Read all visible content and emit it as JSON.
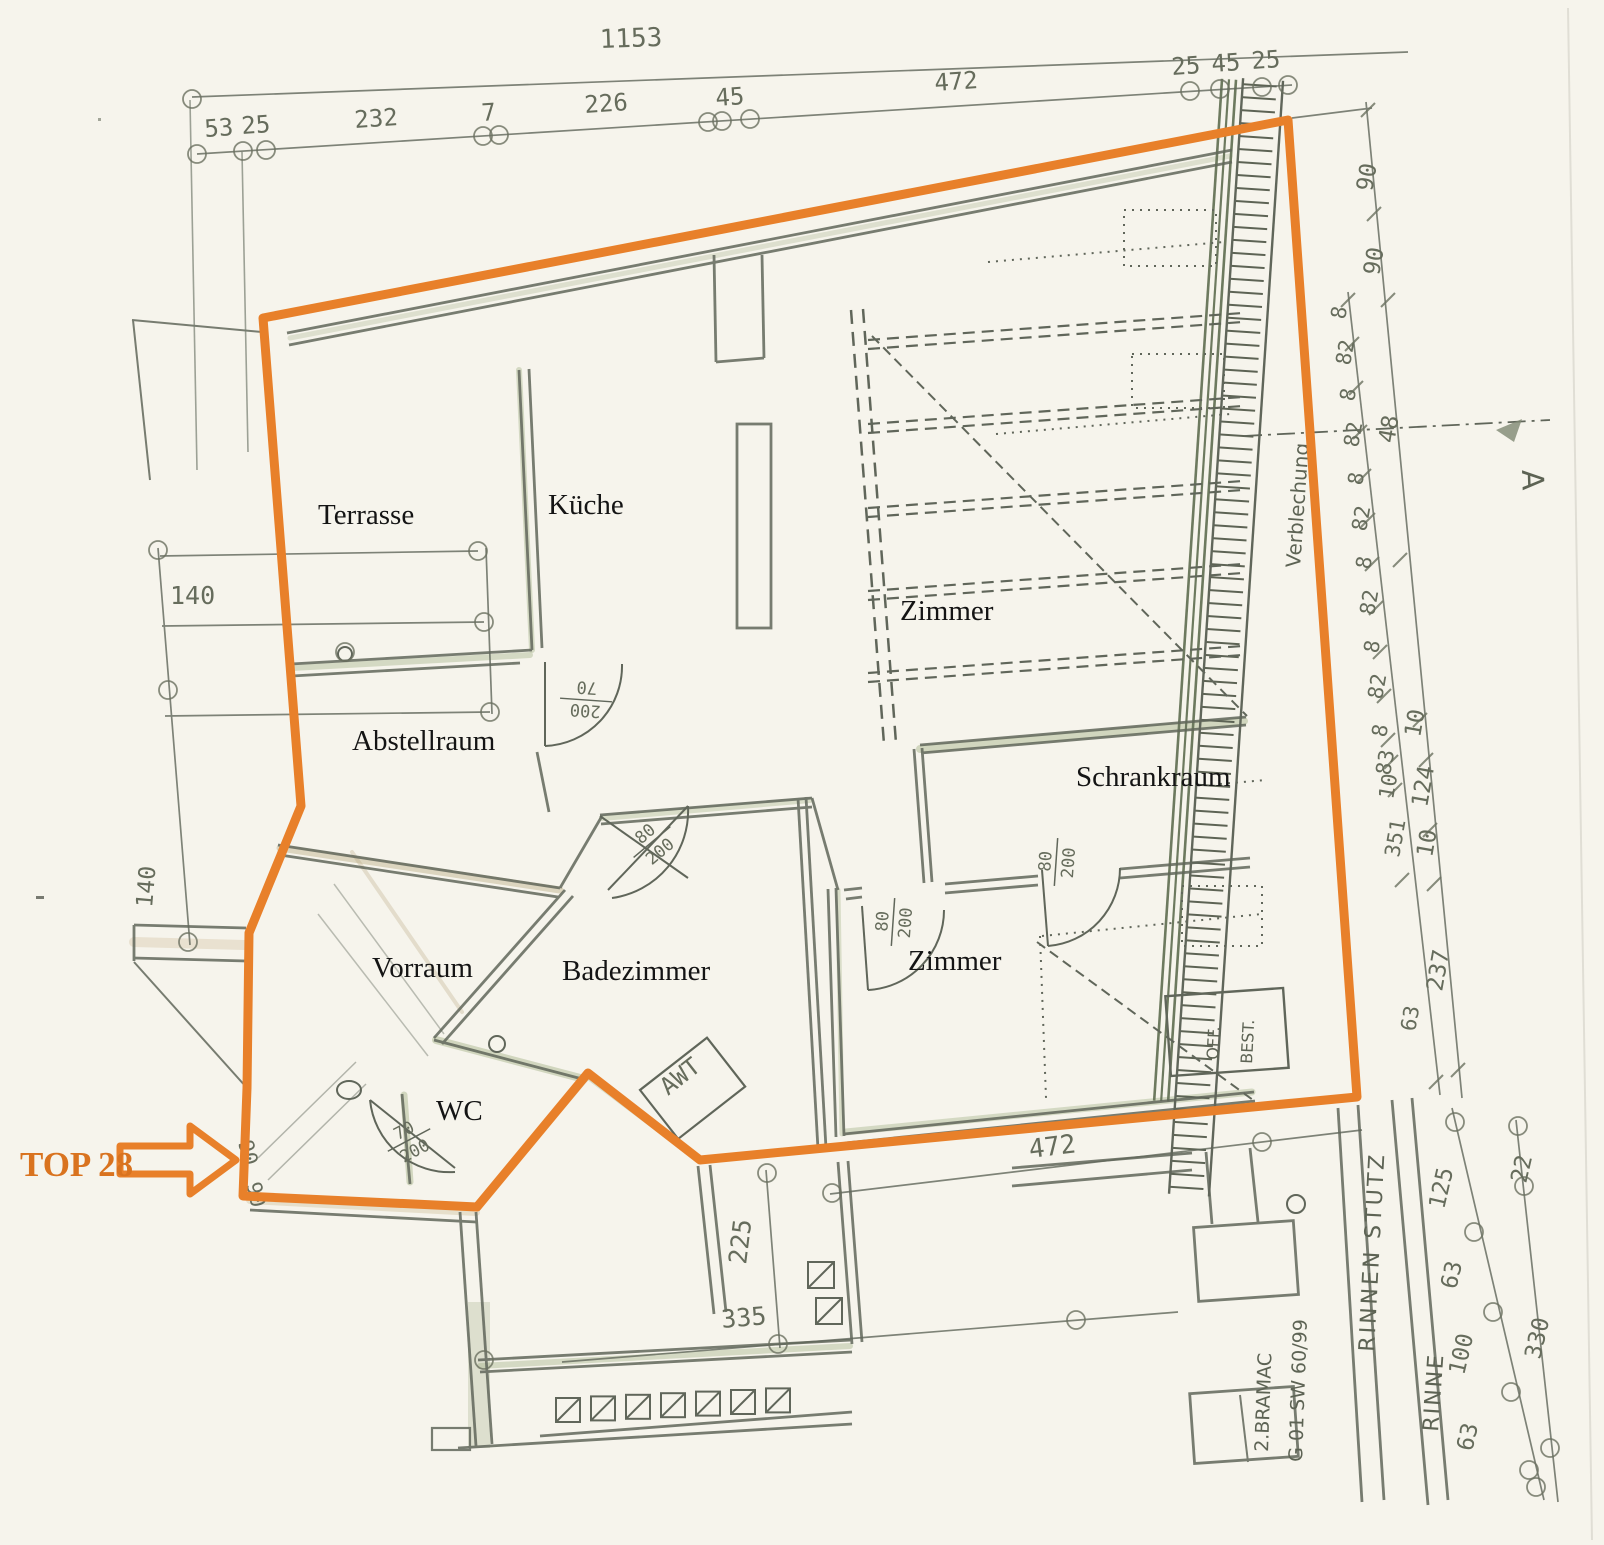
{
  "colors": {
    "paper": "#f6f4ec",
    "pencil": "#60665a",
    "green_tint": "#a3b188",
    "tan_tint": "#c9b68e",
    "orange": "#e8802a",
    "orange_text": "#d9731f",
    "ink": "#141414"
  },
  "highlight": {
    "label": "TOP 28"
  },
  "rooms": {
    "terrasse": "Terrasse",
    "kueche": "Küche",
    "zimmer_oben": "Zimmer",
    "abstellraum": "Abstellraum",
    "schrankraum": "Schrankraum",
    "vorraum": "Vorraum",
    "badezimmer": "Badezimmer",
    "zimmer_unten": "Zimmer",
    "wc": "WC"
  },
  "doors": [
    {
      "id": "abstellraum-door",
      "top": "200",
      "bottom": "70"
    },
    {
      "id": "badezimmer-door",
      "top": "80",
      "bottom": "200"
    },
    {
      "id": "zimmer-door",
      "top": "80",
      "bottom": "200"
    },
    {
      "id": "schrankraum-door",
      "top": "80",
      "bottom": "200"
    },
    {
      "id": "wc-door",
      "top": "70",
      "bottom": "200"
    }
  ],
  "annotations": {
    "verblechung": "Verblechung",
    "rinnen_stutz": "RINNEN STUTZ",
    "rinne": "RINNE",
    "bramac": "2.BRAMAC",
    "tile_code": "G 01 SW 60/99",
    "off_best_1": "OFF.",
    "off_best_2": "BEST.",
    "awt": "AWT",
    "section_marker": "A"
  },
  "dimensions": {
    "top_total": "1153",
    "top_chain": [
      "53",
      "25",
      "232",
      "7",
      "226",
      "45",
      "472",
      "25",
      "45",
      "25"
    ],
    "left_horizontal": "140",
    "left_vertical": "140",
    "entry": [
      "90",
      "90"
    ],
    "right_outer": [
      "90",
      "90",
      "48",
      "10",
      "124",
      "10",
      "237"
    ],
    "right_inner": [
      "8",
      "82",
      "8",
      "82",
      "8",
      "82",
      "8",
      "82",
      "8",
      "82",
      "8",
      "83",
      "10",
      "351",
      "63"
    ],
    "bottom_width": "472",
    "balcony_depth": "225",
    "balcony_width": "335",
    "bottom_right_inner": [
      "125",
      "63",
      "100",
      "63"
    ],
    "bottom_right_outer": [
      "22",
      "330"
    ]
  }
}
